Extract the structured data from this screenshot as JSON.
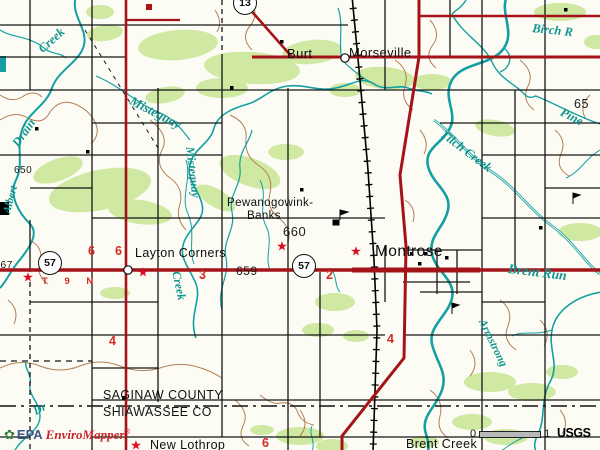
{
  "colors": {
    "road_red": "#a31318",
    "water_teal": "#14a0a2",
    "vegetation_green": "#cfe8a2",
    "contour_brown": "#b28057",
    "marker_red": "#d80f20",
    "number_red": "#d22a25"
  },
  "branding": {
    "epa_flower_icon": "✿",
    "epa_text": "EPA",
    "product_name": "EnviroMapper",
    "registered_mark": "®"
  },
  "credits": {
    "usgs": "USGS"
  },
  "scalebar": {
    "start": "0",
    "end": "1"
  },
  "counties": {
    "line1": "SAGINAW COUNTY",
    "line2": "SHIAWASSEE CO"
  },
  "township_range": {
    "text": "T 9 N"
  },
  "shields": [
    {
      "route": "57",
      "x": 50,
      "y": 263
    },
    {
      "route": "57",
      "x": 304,
      "y": 266
    },
    {
      "route": "13",
      "x": 245,
      "y": 3
    }
  ],
  "stars": [
    {
      "x": 28,
      "y": 277
    },
    {
      "x": 143,
      "y": 272
    },
    {
      "x": 282,
      "y": 246
    },
    {
      "x": 356,
      "y": 251
    },
    {
      "x": 136,
      "y": 445
    }
  ],
  "labels": {
    "places": [
      {
        "text": "Burt",
        "x": 287,
        "y": 47,
        "size": 13
      },
      {
        "text": "Morseville",
        "x": 349,
        "y": 46,
        "size": 13
      },
      {
        "text": "Pewanogowink-",
        "x": 227,
        "y": 198,
        "size": 11.5
      },
      {
        "text": "Banks",
        "x": 247,
        "y": 211,
        "size": 11.5
      },
      {
        "text": "Layton Corners",
        "x": 135,
        "y": 247,
        "size": 12.5
      },
      {
        "text": "Montrose",
        "x": 375,
        "y": 244,
        "size": 15.5
      },
      {
        "text": "New Lothrop",
        "x": 150,
        "y": 439,
        "size": 12.5
      },
      {
        "text": "Brent Creek",
        "x": 406,
        "y": 438,
        "size": 12.5
      }
    ],
    "waters": [
      {
        "text": "Creek",
        "x": 36,
        "y": 46,
        "rot": -42,
        "size": 12.5
      },
      {
        "text": "Drain",
        "x": 10,
        "y": 142,
        "rot": -55,
        "size": 12.5
      },
      {
        "text": "Albert",
        "x": 2,
        "y": 212,
        "rot": -75,
        "size": 11
      },
      {
        "text": "Misteguay",
        "x": 134,
        "y": 94,
        "rot": 27,
        "size": 13
      },
      {
        "text": "Misteguay",
        "x": 196,
        "y": 146,
        "rot": 83,
        "size": 12
      },
      {
        "text": "Creek",
        "x": 182,
        "y": 270,
        "rot": 78,
        "size": 12
      },
      {
        "text": "Tilch Creek",
        "x": 446,
        "y": 128,
        "rot": 37,
        "size": 12.5
      },
      {
        "text": "Pine",
        "x": 564,
        "y": 106,
        "rot": 27,
        "size": 12.5
      },
      {
        "text": "Birch R",
        "x": 533,
        "y": 22,
        "rot": 6,
        "size": 12.5
      },
      {
        "text": "Brent Run",
        "x": 509,
        "y": 262,
        "rot": 7,
        "size": 13.5
      },
      {
        "text": "Armstrong",
        "x": 486,
        "y": 318,
        "rot": 64,
        "size": 11.5
      },
      {
        "text": "Dr",
        "x": 32,
        "y": 408,
        "rot": -28,
        "size": 11.5
      }
    ],
    "elevations": [
      {
        "text": "660",
        "x": 283,
        "y": 225,
        "size": 13
      },
      {
        "text": "659",
        "x": 236,
        "y": 265,
        "size": 12
      },
      {
        "text": "650",
        "x": 14,
        "y": 166,
        "size": 10
      },
      {
        "text": "65",
        "x": 574,
        "y": 98,
        "size": 12.5
      },
      {
        "text": "667",
        "x": -6,
        "y": 260,
        "size": 10.5
      }
    ],
    "section_numbers": [
      {
        "text": "6",
        "x": 88,
        "y": 245
      },
      {
        "text": "6",
        "x": 115,
        "y": 245
      },
      {
        "text": "3",
        "x": 199,
        "y": 269
      },
      {
        "text": "2",
        "x": 326,
        "y": 269
      },
      {
        "text": "4",
        "x": 109,
        "y": 335
      },
      {
        "text": "4",
        "x": 387,
        "y": 333
      },
      {
        "text": "6",
        "x": 262,
        "y": 437
      }
    ]
  }
}
